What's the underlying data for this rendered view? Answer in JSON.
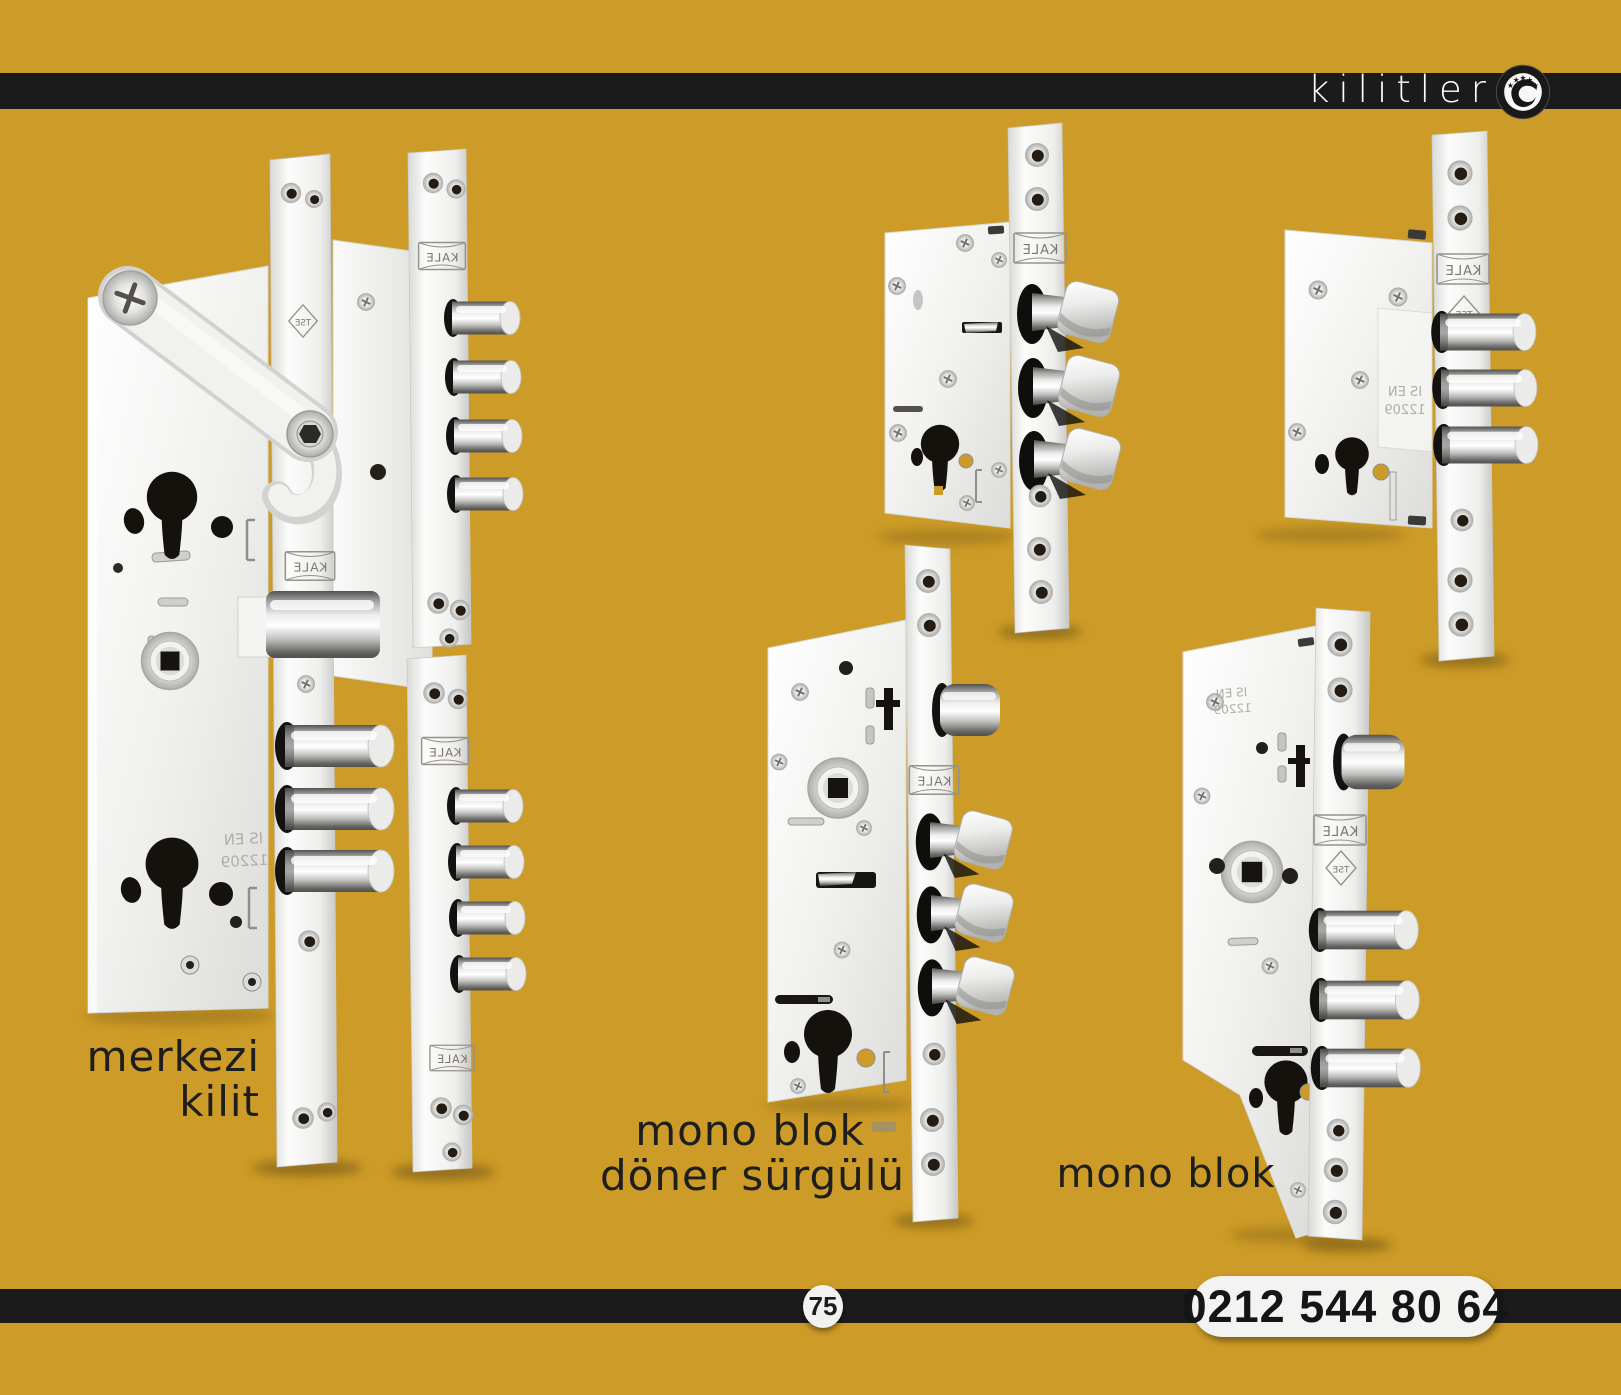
{
  "page": {
    "background_color": "#cd9b27",
    "bar_color": "#1b1b1b"
  },
  "header": {
    "brand": "kilitler",
    "logo_icon": "kale-stars-swoosh-emblem"
  },
  "products": [
    {
      "name": "merkezi kilit",
      "label_lines": [
        "merkezi",
        "kilit"
      ]
    },
    {
      "name": "mono blok döner sürgülü",
      "label_lines": [
        "mono blok",
        "döner sürgülü"
      ]
    },
    {
      "name": "mono blok",
      "label_lines": [
        "mono blok"
      ]
    }
  ],
  "markings": {
    "brand": "KALE",
    "cert": "TSE",
    "standard_line1": "IS EN",
    "standard_line2": "12209"
  },
  "footer": {
    "page_number": "75",
    "phone": "0212 544 80 64"
  }
}
